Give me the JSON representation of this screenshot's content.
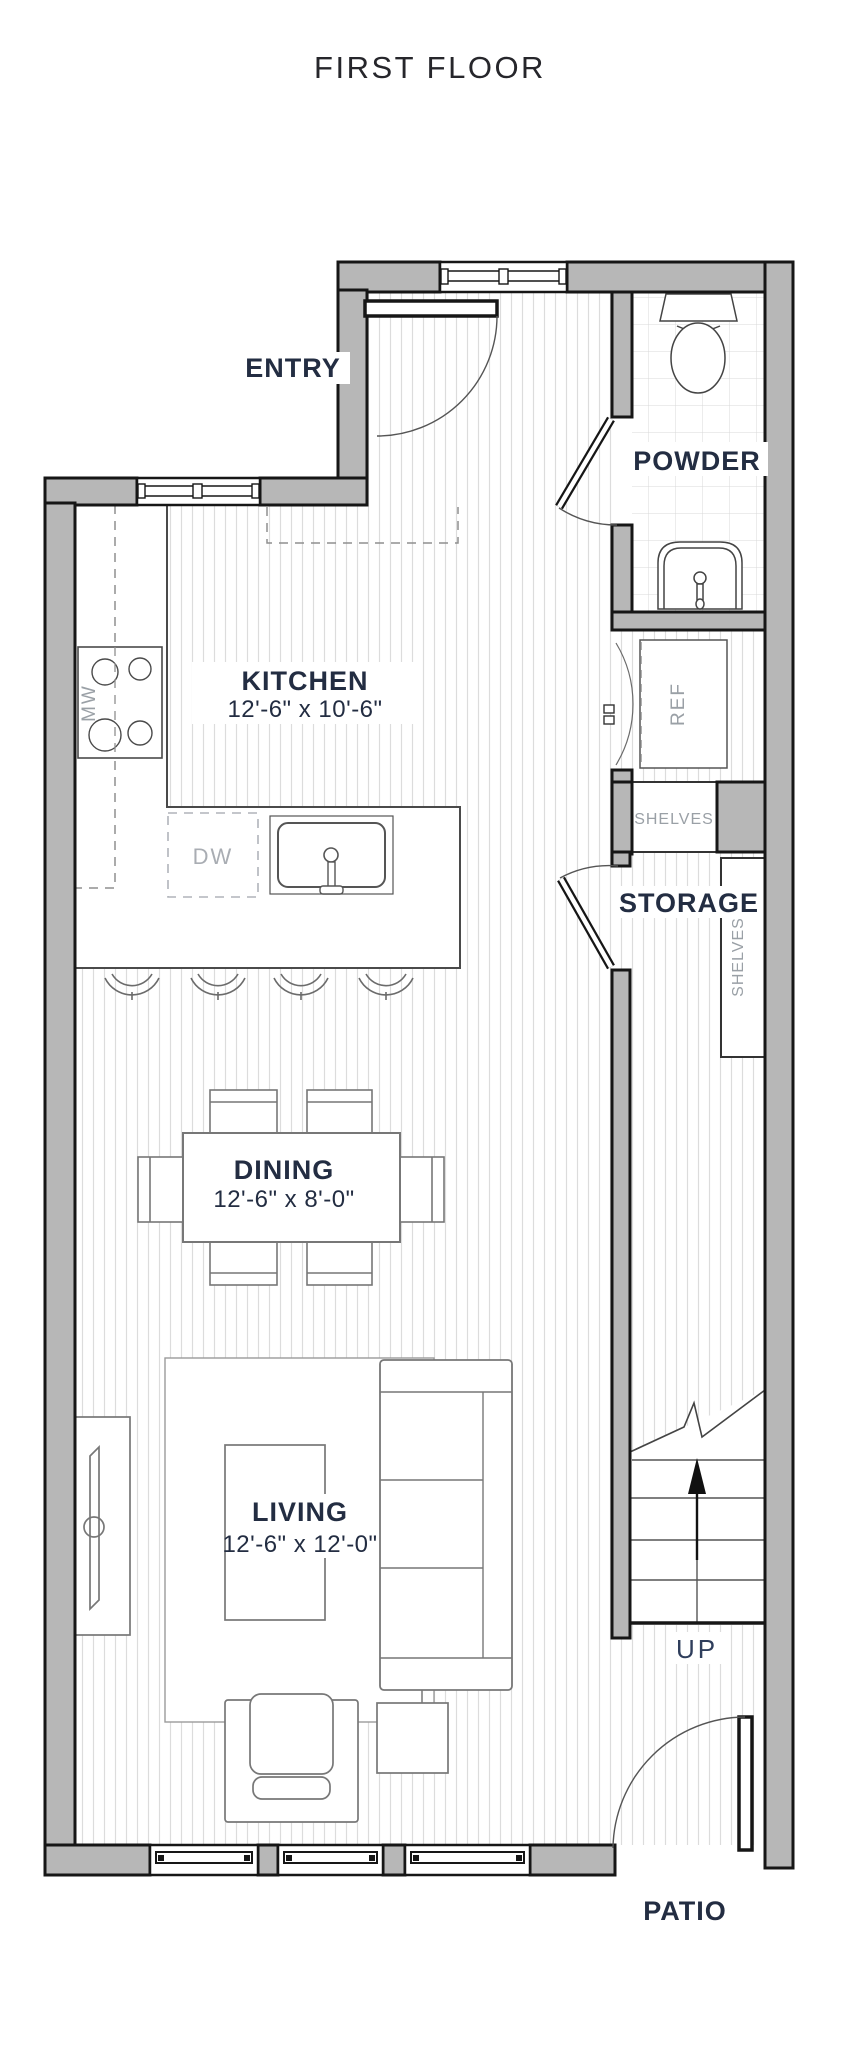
{
  "title": "FIRST FLOOR",
  "rooms": {
    "entry": {
      "label": "ENTRY"
    },
    "powder": {
      "label": "POWDER"
    },
    "kitchen": {
      "label": "KITCHEN",
      "dims": "12'-6\" x 10'-6\""
    },
    "storage": {
      "label": "STORAGE"
    },
    "dining": {
      "label": "DINING",
      "dims": "12'-6\" x 8'-0\""
    },
    "living": {
      "label": "LIVING",
      "dims": "12'-6\" x 12'-0\""
    },
    "patio": {
      "label": "PATIO"
    }
  },
  "fixtures": {
    "microwave": "MW",
    "dishwasher": "DW",
    "refrigerator": "REF",
    "shelves_kitchen": "SHELVES",
    "shelves_storage": "SHELVES",
    "stairs_direction": "UP"
  },
  "colors": {
    "wall_fill": "#b7b7b7",
    "line": "#161616",
    "label": "#232d42",
    "muted_label": "#9aa0a6",
    "floor_line": "#dcdcdc"
  }
}
